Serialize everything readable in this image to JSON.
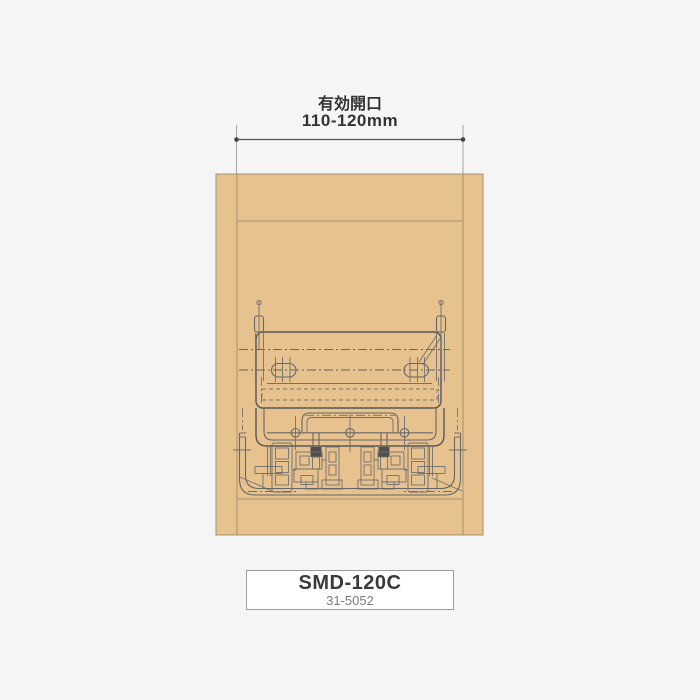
{
  "dimension": {
    "label": "有効開口",
    "value": "110-120mm"
  },
  "product": {
    "model": "SMD-120C",
    "code": "31-5052"
  },
  "colors": {
    "background": "#f5f5f6",
    "wood": "#e7c28f",
    "wood_border": "#a6906f",
    "panel_white": "#ffffff",
    "drawing_line": "#666666",
    "dimension_line": "#555555",
    "text": "#333333",
    "code_text": "#7d7d7d",
    "label_box_border": "#9b9b9b"
  }
}
